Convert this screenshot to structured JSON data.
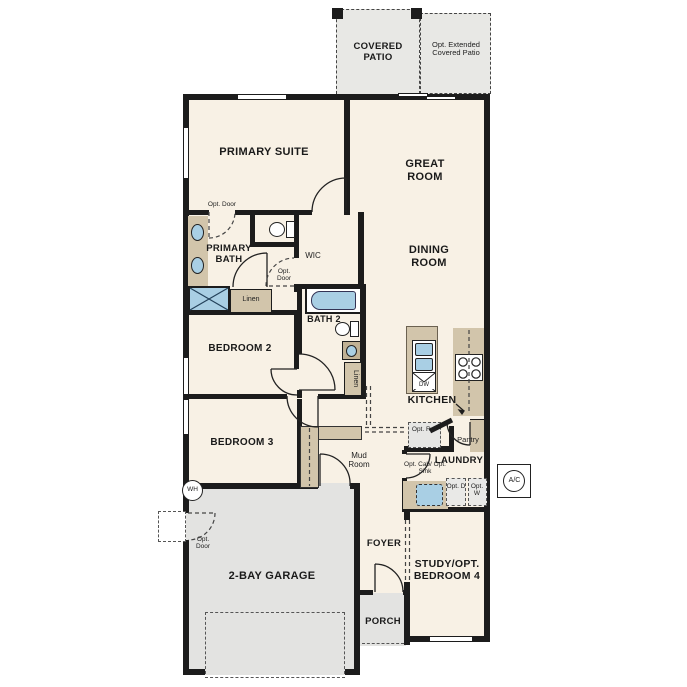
{
  "labels": {
    "covered_patio": "COVERED PATIO",
    "opt_extended_patio": "Opt. Extended Covered Patio",
    "primary_suite": "PRIMARY SUITE",
    "opt_door": "Opt. Door",
    "great_room": "GREAT ROOM",
    "dining_room": "DINING ROOM",
    "primary_bath": "PRIMARY BATH",
    "wic": "WIC",
    "linen": "Linen",
    "bath2": "BATH 2",
    "bedroom2": "BEDROOM 2",
    "bedroom3": "BEDROOM 3",
    "kitchen": "KITCHEN",
    "dw": "DW",
    "opt_ref": "Opt. Ref",
    "pantry": "Pantry",
    "laundry": "LAUNDRY",
    "opt_cab_sink": "Opt. Cab/ Opt. Sink",
    "opt_d": "Opt. D",
    "opt_w": "Opt. W",
    "ac": "A/C",
    "wh": "WH",
    "mud_room": "Mud Room",
    "foyer": "FOYER",
    "study_bedroom4": "STUDY/OPT. BEDROOM 4",
    "porch": "PORCH",
    "garage": "2-BAY GARAGE"
  },
  "colors": {
    "wall": "#1c1c1c",
    "interior": "#f8f1e5",
    "patio_gray": "#e8e8e5",
    "garage_gray": "#e3e3e1",
    "cabinet_tan": "#d2c5ab",
    "fixture_blue": "#a9cfe4"
  }
}
